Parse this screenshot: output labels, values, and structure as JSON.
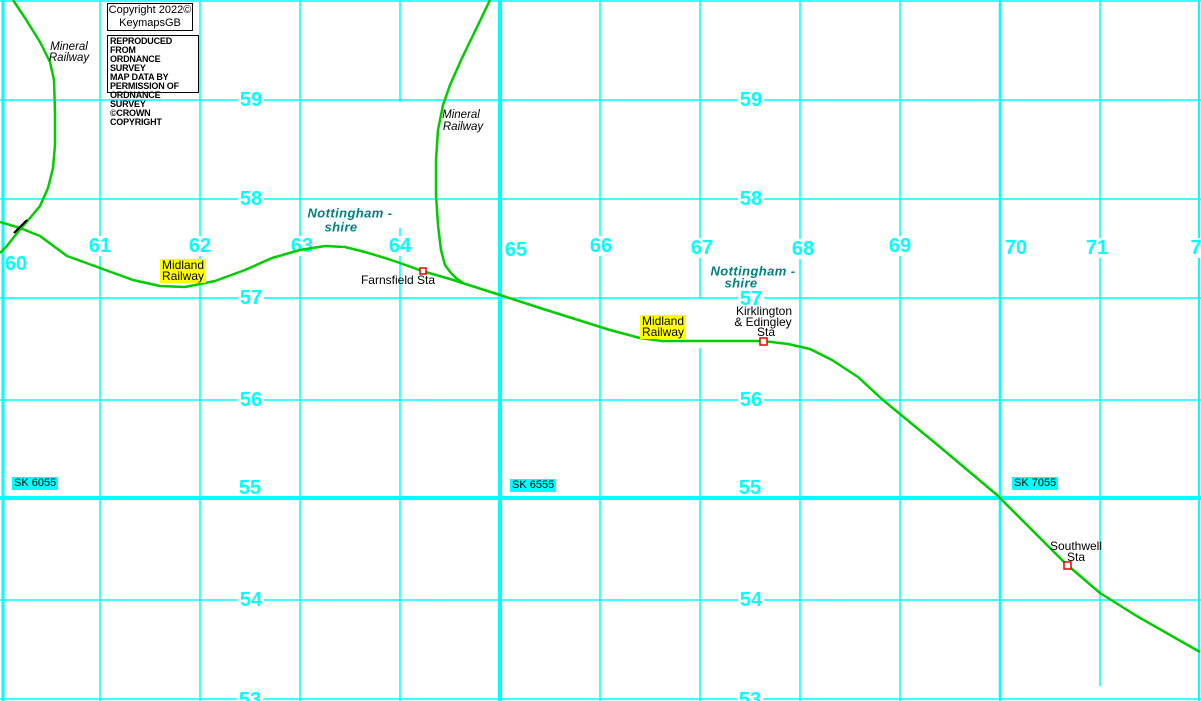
{
  "map": {
    "colors": {
      "background": "#FFFFFF",
      "grid": "#00FFFF",
      "grid_number": "#00FFFF",
      "railway": "#00CC00",
      "station_marker": "#EE0000",
      "county_text": "#008080",
      "railway_highlight": "#FFFF00",
      "crossing_mark": "#000000"
    },
    "grid": {
      "v_segments": [
        {
          "x": 3,
          "y1": 0,
          "y2": 701,
          "w": 3
        },
        {
          "x": 100,
          "y1": 1,
          "y2": 701,
          "w": 1.5
        },
        {
          "x": 200,
          "y1": 1,
          "y2": 701,
          "w": 1.5
        },
        {
          "x": 300,
          "y1": 1,
          "y2": 701,
          "w": 1.5
        },
        {
          "x": 400,
          "y1": 1,
          "y2": 102,
          "w": 1.5
        },
        {
          "x": 400,
          "y1": 228,
          "y2": 701,
          "w": 1.5
        },
        {
          "x": 500,
          "y1": 0,
          "y2": 701,
          "w": 4
        },
        {
          "x": 600,
          "y1": 1,
          "y2": 701,
          "w": 1.5
        },
        {
          "x": 700,
          "y1": 1,
          "y2": 298,
          "w": 1.5
        },
        {
          "x": 700,
          "y1": 348,
          "y2": 701,
          "w": 1.5
        },
        {
          "x": 800,
          "y1": 1,
          "y2": 701,
          "w": 1.5
        },
        {
          "x": 900,
          "y1": 1,
          "y2": 701,
          "w": 1.5
        },
        {
          "x": 1000,
          "y1": 0,
          "y2": 701,
          "w": 2.5
        },
        {
          "x": 1100,
          "y1": 1,
          "y2": 686,
          "w": 1.5
        },
        {
          "x": 1199,
          "y1": 0,
          "y2": 701,
          "w": 2
        }
      ],
      "h_segments": [
        {
          "y": 1,
          "x1": 0,
          "x2": 1201,
          "w": 1.5
        },
        {
          "y": 100,
          "x1": 0,
          "x2": 1201,
          "w": 1.5
        },
        {
          "y": 199,
          "x1": 0,
          "x2": 1201,
          "w": 1.5
        },
        {
          "y": 298,
          "x1": 0,
          "x2": 1201,
          "w": 1.5
        },
        {
          "y": 400,
          "x1": 0,
          "x2": 1201,
          "w": 1.5
        },
        {
          "y": 498,
          "x1": 0,
          "x2": 1201,
          "w": 4
        },
        {
          "y": 600,
          "x1": 0,
          "x2": 1201,
          "w": 1.5
        },
        {
          "y": 699,
          "x1": 0,
          "x2": 1201,
          "w": 1.5
        }
      ],
      "numbers": [
        {
          "text": "60",
          "x": 16,
          "y": 264,
          "bg": "none"
        },
        {
          "text": "61",
          "x": 100,
          "y": 246,
          "bg": "white"
        },
        {
          "text": "62",
          "x": 200,
          "y": 246,
          "bg": "white"
        },
        {
          "text": "63",
          "x": 302,
          "y": 246,
          "bg": "white"
        },
        {
          "text": "64",
          "x": 400,
          "y": 246,
          "bg": "white"
        },
        {
          "text": "65",
          "x": 516,
          "y": 250,
          "bg": "none"
        },
        {
          "text": "66",
          "x": 601,
          "y": 246,
          "bg": "white"
        },
        {
          "text": "67",
          "x": 702,
          "y": 248,
          "bg": "white"
        },
        {
          "text": "68",
          "x": 803,
          "y": 249,
          "bg": "white"
        },
        {
          "text": "69",
          "x": 900,
          "y": 246,
          "bg": "white"
        },
        {
          "text": "70",
          "x": 1016,
          "y": 248,
          "bg": "none"
        },
        {
          "text": "71",
          "x": 1097,
          "y": 248,
          "bg": "white"
        },
        {
          "text": "7",
          "x": 1196,
          "y": 248,
          "bg": "white"
        },
        {
          "text": "59",
          "x": 251,
          "y": 100,
          "bg": "white"
        },
        {
          "text": "59",
          "x": 751,
          "y": 100,
          "bg": "white"
        },
        {
          "text": "58",
          "x": 251,
          "y": 199,
          "bg": "white"
        },
        {
          "text": "58",
          "x": 751,
          "y": 199,
          "bg": "white"
        },
        {
          "text": "57",
          "x": 251,
          "y": 298,
          "bg": "white"
        },
        {
          "text": "57",
          "x": 751,
          "y": 299,
          "bg": "white"
        },
        {
          "text": "56",
          "x": 251,
          "y": 400,
          "bg": "white"
        },
        {
          "text": "56",
          "x": 751,
          "y": 400,
          "bg": "white"
        },
        {
          "text": "55",
          "x": 250,
          "y": 488,
          "bg": "none"
        },
        {
          "text": "55",
          "x": 750,
          "y": 488,
          "bg": "none"
        },
        {
          "text": "54",
          "x": 251,
          "y": 600,
          "bg": "white"
        },
        {
          "text": "54",
          "x": 751,
          "y": 600,
          "bg": "white"
        },
        {
          "text": "53",
          "x": 250,
          "y": 700,
          "bg": "white"
        },
        {
          "text": "53",
          "x": 750,
          "y": 700,
          "bg": "white"
        }
      ]
    },
    "grid_refs": [
      {
        "text": "SK 6055",
        "x": 12,
        "y": 477
      },
      {
        "text": "SK 6555",
        "x": 510,
        "y": 479
      },
      {
        "text": "SK 7055",
        "x": 1012,
        "y": 477
      }
    ],
    "railways": [
      {
        "name": "midland-railway-main-line",
        "points": [
          [
            0,
            222
          ],
          [
            20,
            228
          ],
          [
            40,
            236
          ],
          [
            67,
            256
          ],
          [
            100,
            268
          ],
          [
            133,
            280
          ],
          [
            160,
            286
          ],
          [
            185,
            287
          ],
          [
            215,
            281
          ],
          [
            245,
            270
          ],
          [
            272,
            258
          ],
          [
            300,
            250
          ],
          [
            325,
            246
          ],
          [
            345,
            247
          ],
          [
            365,
            252
          ],
          [
            385,
            258
          ],
          [
            400,
            263
          ],
          [
            422,
            271
          ],
          [
            450,
            279
          ],
          [
            475,
            287
          ],
          [
            500,
            295
          ],
          [
            540,
            308
          ],
          [
            575,
            319
          ],
          [
            610,
            330
          ],
          [
            640,
            338
          ],
          [
            662,
            341
          ],
          [
            763,
            341
          ],
          [
            788,
            344
          ],
          [
            810,
            349
          ],
          [
            832,
            360
          ],
          [
            858,
            377
          ],
          [
            883,
            400
          ],
          [
            940,
            447
          ],
          [
            997,
            495
          ],
          [
            1030,
            528
          ],
          [
            1065,
            563
          ],
          [
            1100,
            593
          ],
          [
            1135,
            615
          ],
          [
            1170,
            635
          ],
          [
            1200,
            652
          ]
        ]
      },
      {
        "name": "mineral-railway-west",
        "points": [
          [
            13,
            0
          ],
          [
            25,
            18
          ],
          [
            40,
            42
          ],
          [
            50,
            62
          ],
          [
            54,
            80
          ],
          [
            55,
            112
          ],
          [
            55,
            145
          ],
          [
            53,
            168
          ],
          [
            48,
            188
          ],
          [
            40,
            206
          ],
          [
            30,
            218
          ],
          [
            22,
            227
          ],
          [
            14,
            237
          ],
          [
            6,
            247
          ],
          [
            0,
            253
          ]
        ]
      },
      {
        "name": "mineral-railway-central",
        "points": [
          [
            490,
            0
          ],
          [
            478,
            25
          ],
          [
            462,
            58
          ],
          [
            450,
            85
          ],
          [
            443,
            105
          ],
          [
            438,
            130
          ],
          [
            436,
            160
          ],
          [
            436,
            195
          ],
          [
            438,
            225
          ],
          [
            441,
            250
          ],
          [
            445,
            265
          ],
          [
            451,
            273
          ],
          [
            456,
            278
          ],
          [
            463,
            283
          ]
        ]
      }
    ],
    "crossing_marks": [
      {
        "x1": 14,
        "y1": 233,
        "x2": 27,
        "y2": 220
      }
    ],
    "stations": [
      {
        "name": "Farnsfield Sta",
        "marker": {
          "x": 420,
          "y": 268,
          "w": 6,
          "h": 6
        },
        "label_lines": [
          {
            "text": "Farnsfield Sta",
            "x": 398,
            "y": 280
          }
        ]
      },
      {
        "name": "Kirklington & Edingley Sta",
        "marker": {
          "x": 760,
          "y": 338,
          "w": 7,
          "h": 7
        },
        "label_lines": [
          {
            "text": "Kirklington",
            "x": 764,
            "y": 311
          },
          {
            "text": "& Edingley",
            "x": 763,
            "y": 322
          },
          {
            "text": "Sta",
            "x": 766,
            "y": 332
          }
        ]
      },
      {
        "name": "Southwell Sta",
        "marker": {
          "x": 1064,
          "y": 562,
          "w": 7,
          "h": 7
        },
        "label_lines": [
          {
            "text": "Southwell",
            "x": 1076,
            "y": 546
          },
          {
            "text": "Sta",
            "x": 1076,
            "y": 557
          }
        ]
      }
    ],
    "county_labels": [
      {
        "lines": [
          {
            "text": "Nottingham -",
            "x": 350,
            "y": 213
          },
          {
            "text": "shire",
            "x": 341,
            "y": 227
          }
        ]
      },
      {
        "lines": [
          {
            "text": "Nottingham -",
            "x": 753,
            "y": 271
          },
          {
            "text": "shire",
            "x": 741,
            "y": 283
          }
        ]
      }
    ],
    "mineral_labels": [
      {
        "lines": [
          {
            "text": "Mineral",
            "x": 69,
            "y": 47
          },
          {
            "text": "Railway",
            "x": 69,
            "y": 58
          }
        ]
      },
      {
        "lines": [
          {
            "text": "Mineral",
            "x": 461,
            "y": 115
          },
          {
            "text": "Railway",
            "x": 463,
            "y": 127
          }
        ]
      }
    ],
    "highlight_labels": [
      {
        "lines": [
          "Midland",
          "Railway"
        ],
        "x": 160,
        "y": 259
      },
      {
        "lines": [
          "Midland",
          "Railway"
        ],
        "x": 640,
        "y": 315
      }
    ]
  },
  "copyright": {
    "line1": "Copyright 2022©",
    "line2": "KeymapsGB",
    "notice_lines": [
      "REPRODUCED FROM",
      "ORDNANCE SURVEY",
      "MAP DATA BY",
      "PERMISSION OF",
      "ORDNANCE SURVEY",
      "©CROWN COPYRIGHT"
    ]
  }
}
